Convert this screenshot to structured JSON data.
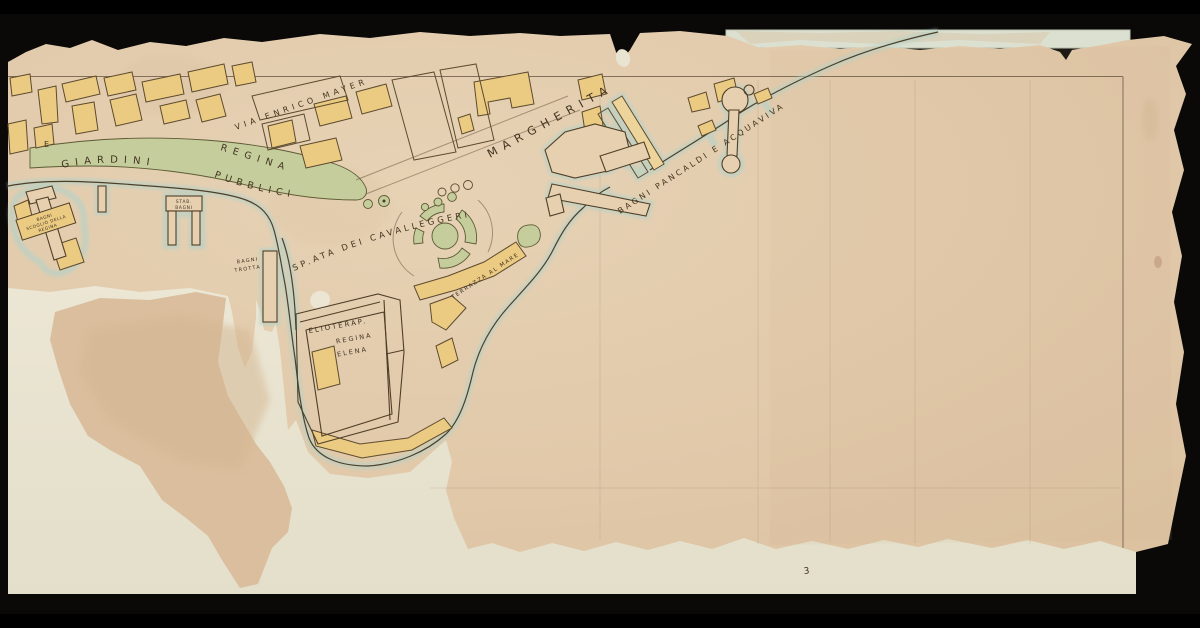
{
  "labels": {
    "via_enrico_mayer": "VIA ENRICO MAYER",
    "viale_regina": "REGINA",
    "viale_margherita": "MARGHERITA",
    "giardini": "GIARDINI",
    "pubblici": "PUBBLICI",
    "spianata_cavalleggeri": "SP.ATA DEI CAVALLEGGERI",
    "bagni_pancaldi_acquaviva": "BAGNI PANCALDI E ACQUAVIVA",
    "terrazza_al_mare": "TERRAZZA AL MARE",
    "elioterap": "ELIOTERAP.",
    "elioterap_regina": "REGINA",
    "elioterap_elena": "ELENA",
    "trotta_line1": "BAGNI",
    "trotta_line2": "TROTTA",
    "stab_line1": "STAB.",
    "stab_line2": "BAGNI",
    "scoglio_line1": "BAGNI",
    "scoglio_line2": "SCOGLIO DELLA",
    "scoglio_line3": "REGINA",
    "edge_letter": "E",
    "sheet_mark": "3"
  },
  "colors": {
    "background": "#0a0908",
    "paper": "#e2cbad",
    "paper_dark_patch": "#dabe9d",
    "backing_paper": "#ece6d4",
    "top_strip": "#dbe0d1",
    "building_yellow": "#ebca82",
    "garden_green": "#c5cd9d",
    "water_halo": "#b0d2c9",
    "ink": "#4a3b26"
  }
}
